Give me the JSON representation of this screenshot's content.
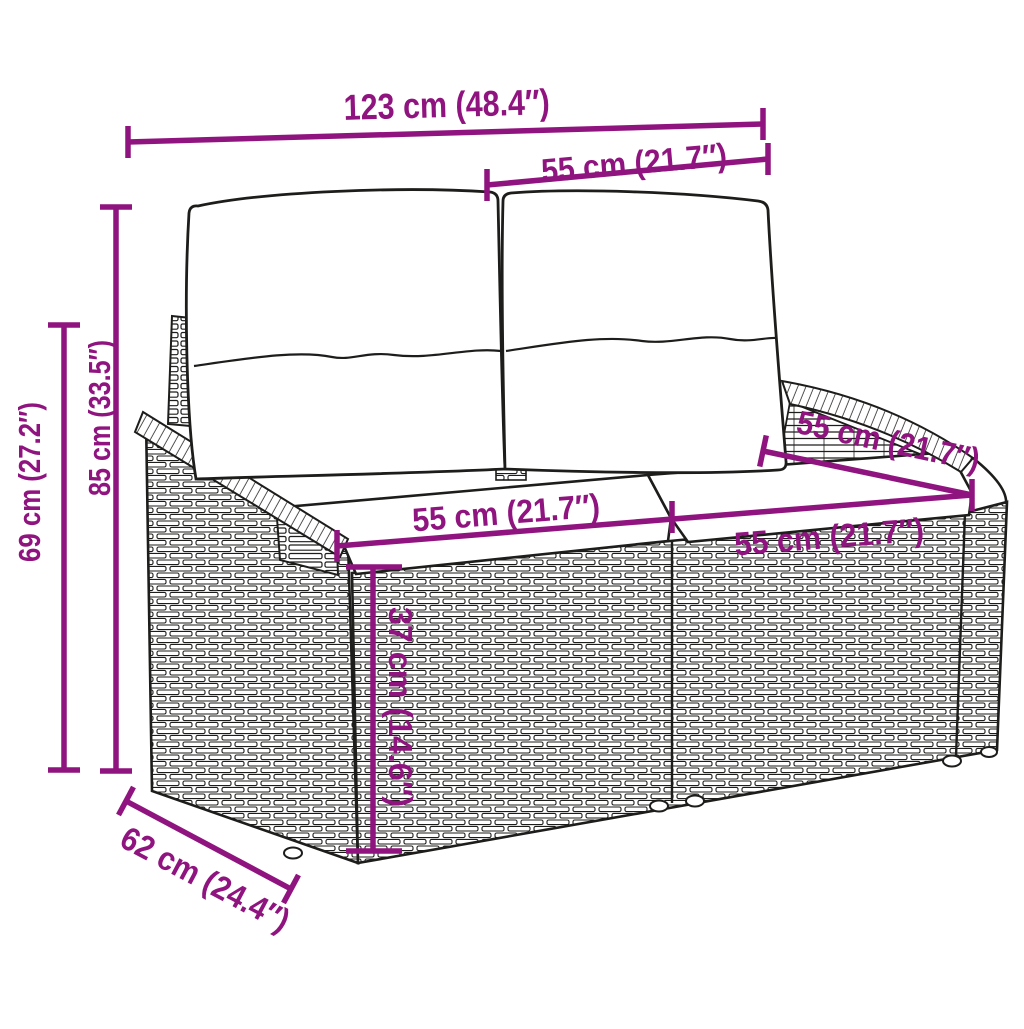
{
  "diagram": {
    "subject": "wicker loveseat sofa with back and seat cushions",
    "colors": {
      "dimension_accent": "#90147f",
      "line_art": "#1d1d1b",
      "background": "#ffffff"
    },
    "labels": {
      "total_width": "123 cm (48.4″)",
      "backrest_width": "55 cm (21.7″)",
      "total_height": "85 cm (33.5″)",
      "armrest_height": "69 cm (27.2″)",
      "seat_width_left": "55 cm (21.7″)",
      "seat_depth_top": "55 cm (21.7″)",
      "seat_width_right": "55 cm (21.7″)",
      "seat_height": "37 cm (14.6″)",
      "base_depth": "62 cm (24.4″)"
    }
  }
}
